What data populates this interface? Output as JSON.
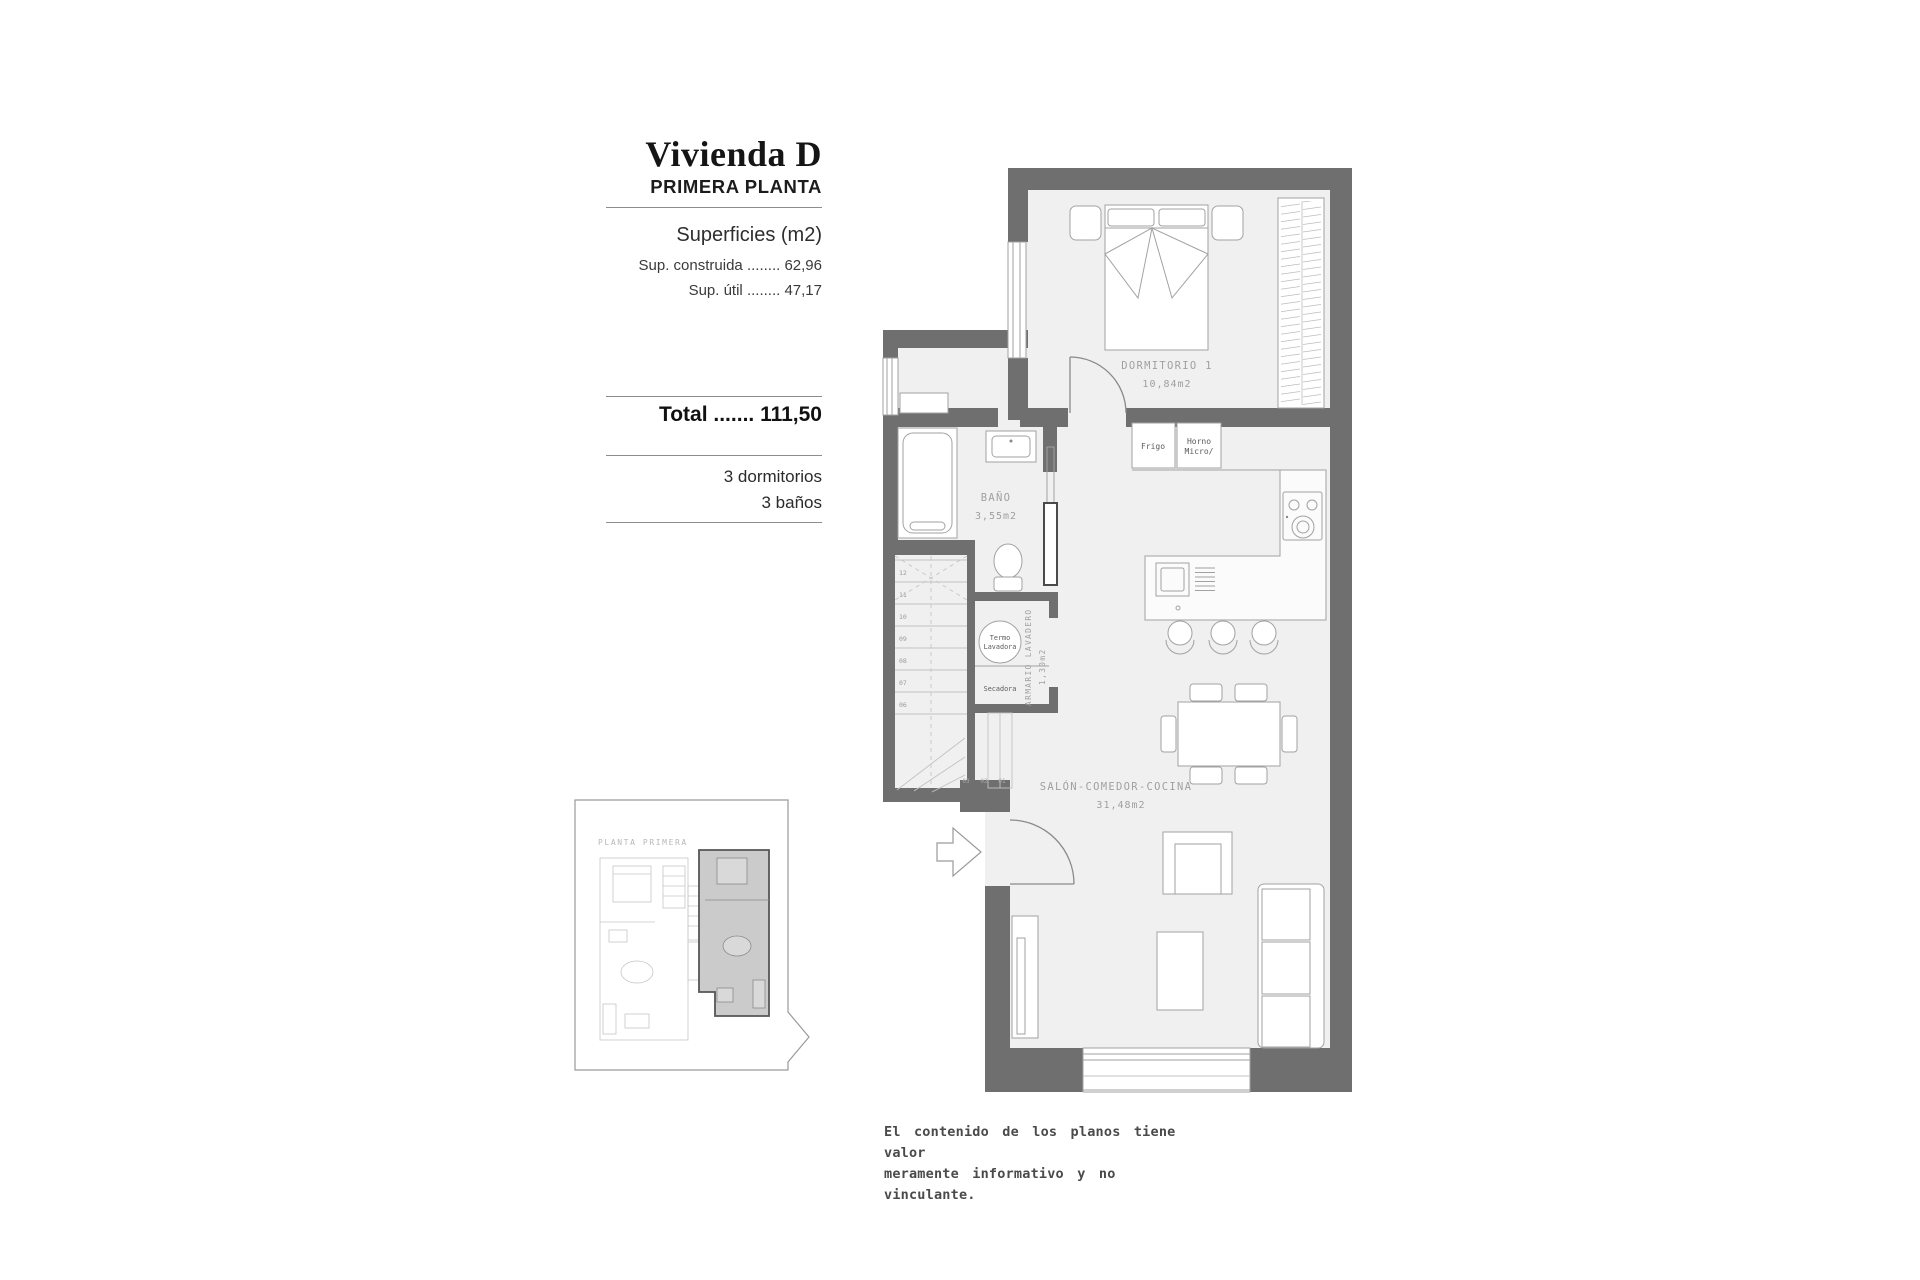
{
  "colors": {
    "wall": "#6f6f6f",
    "floor": "#f0f0f0",
    "line": "#a2a2a2",
    "label": "#a0a0a0",
    "rule": "#8d8d8d",
    "highlight": "#cbcbcb",
    "text": "#1f1f1f"
  },
  "panel": {
    "title": "Vivienda D",
    "subtitle": "PRIMERA PLANTA",
    "surfaces_heading": "Superficies (m2)",
    "surface_rows": [
      {
        "label": "Sup. construida",
        "dots": "........",
        "value": "62,96"
      },
      {
        "label": "Sup. útil",
        "dots": "........",
        "value": "47,17"
      }
    ],
    "total": {
      "label": "Total",
      "dots": ".......",
      "value": "111,50"
    },
    "features": [
      "3 dormitorios",
      "3 baños"
    ]
  },
  "plan": {
    "rooms": {
      "dormitorio": {
        "name": "DORMITORIO 1",
        "area": "10,84m2"
      },
      "bano": {
        "name": "BAÑO",
        "area": "3,55m2"
      },
      "salon": {
        "name": "SALÓN-COMEDOR-COCINA",
        "area": "31,48m2"
      },
      "armario": {
        "name": "ARMARIO LAVADERO",
        "area": "1,30m2"
      }
    },
    "appliances": {
      "frigo": "Frigo",
      "horno_line1": "Horno",
      "horno_line2": "Micro/",
      "termo_line1": "Termo",
      "termo_line2": "Lavadora",
      "secadora": "Secadora"
    },
    "stairs": {
      "upper_steps": [
        "12",
        "11",
        "10",
        "09",
        "08",
        "07",
        "06"
      ],
      "lower_steps": [
        "03",
        "02",
        "01"
      ]
    }
  },
  "key_plan": {
    "label": "PLANTA PRIMERA"
  },
  "disclaimer": {
    "line1": "El contenido de los planos tiene valor",
    "line2": "meramente informativo y no vinculante."
  }
}
